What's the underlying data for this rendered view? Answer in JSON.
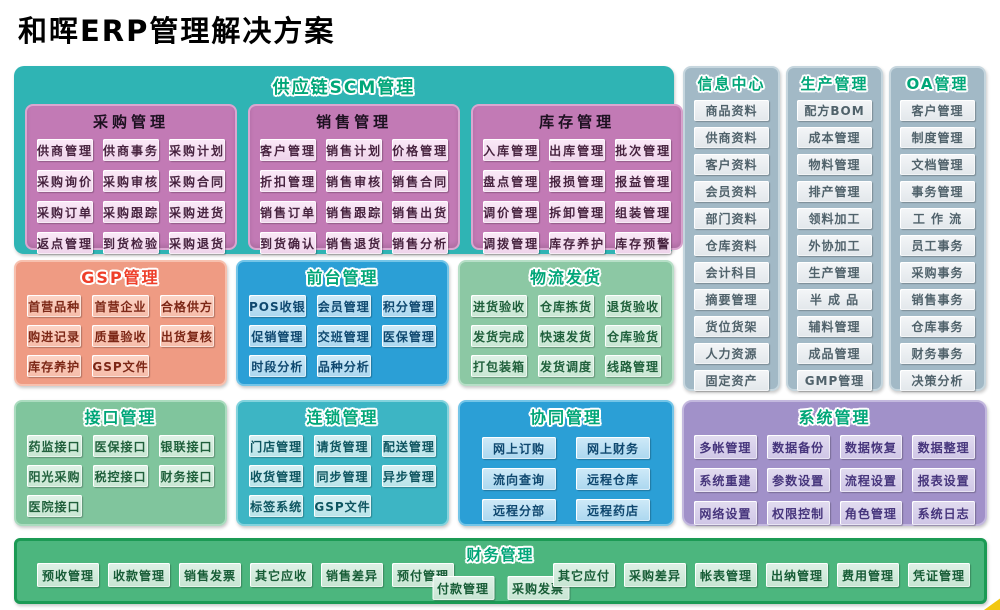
{
  "page_title": "和晖ERP管理解决方案",
  "colors": {
    "scm_bg": "#2fb4b4",
    "subpanel_bg": "#c27ab5",
    "gsp_bg": "#ef9b83",
    "blue_bg": "#2b9fd6",
    "logistics_bg": "#8cc8a4",
    "interface_bg": "#80c59d",
    "chain_bg": "#3db5c4",
    "system_bg": "#a191c9",
    "finance_bg": "#4cb67e",
    "column_bg": "#a2b9c6",
    "title_green": "#00a678",
    "gsp_title_red": "#ee3f2a",
    "corner_yellow": "#f2c711"
  },
  "panels": {
    "scm": {
      "title": "供应链SCM管理",
      "sections": [
        {
          "title": "采购管理",
          "buttons": [
            "供商管理",
            "供商事务",
            "采购计划",
            "采购询价",
            "采购审核",
            "采购合同",
            "采购订单",
            "采购跟踪",
            "采购进货",
            "返点管理",
            "到货检验",
            "采购退货"
          ]
        },
        {
          "title": "销售管理",
          "buttons": [
            "客户管理",
            "销售计划",
            "价格管理",
            "折扣管理",
            "销售审核",
            "销售合同",
            "销售订单",
            "销售跟踪",
            "销售出货",
            "到货确认",
            "销售退货",
            "销售分析"
          ]
        },
        {
          "title": "库存管理",
          "buttons": [
            "入库管理",
            "出库管理",
            "批次管理",
            "盘点管理",
            "报损管理",
            "报益管理",
            "调价管理",
            "拆卸管理",
            "组装管理",
            "调拨管理",
            "库存养护",
            "库存预警"
          ]
        }
      ]
    },
    "info_center": {
      "title": "信息中心",
      "buttons": [
        "商品资料",
        "供商资料",
        "客户资料",
        "会员资料",
        "部门资料",
        "仓库资料",
        "会计科目",
        "摘要管理",
        "货位货架",
        "人力资源",
        "固定资产"
      ]
    },
    "production": {
      "title": "生产管理",
      "buttons": [
        "配方BOM",
        "成本管理",
        "物料管理",
        "排产管理",
        "领料加工",
        "外协加工",
        "生产管理",
        "半 成 品",
        "辅料管理",
        "成品管理",
        "GMP管理"
      ]
    },
    "oa": {
      "title": "OA管理",
      "buttons": [
        "客户管理",
        "制度管理",
        "文档管理",
        "事务管理",
        "工 作 流",
        "员工事务",
        "采购事务",
        "销售事务",
        "仓库事务",
        "财务事务",
        "决策分析"
      ]
    },
    "gsp": {
      "title": "GSP管理",
      "buttons": [
        "首营品种",
        "首营企业",
        "合格供方",
        "购进记录",
        "质量验收",
        "出货复核",
        "库存养护",
        "GSP文件"
      ]
    },
    "front_desk": {
      "title": "前台管理",
      "buttons": [
        "POS收银",
        "会员管理",
        "积分管理",
        "促销管理",
        "交班管理",
        "医保管理",
        "时段分析",
        "品种分析"
      ]
    },
    "logistics": {
      "title": "物流发货",
      "buttons": [
        "进货验收",
        "仓库拣货",
        "退货验收",
        "发货完成",
        "快速发货",
        "仓库验货",
        "打包装箱",
        "发货调度",
        "线路管理"
      ]
    },
    "interface": {
      "title": "接口管理",
      "buttons": [
        "药监接口",
        "医保接口",
        "银联接口",
        "阳光采购",
        "税控接口",
        "财务接口",
        "医院接口"
      ]
    },
    "chain": {
      "title": "连锁管理",
      "buttons": [
        "门店管理",
        "请货管理",
        "配送管理",
        "收货管理",
        "同步管理",
        "异步管理",
        "标签系统",
        "GSP文件"
      ]
    },
    "collaboration": {
      "title": "协同管理",
      "buttons": [
        "网上订购",
        "网上财务",
        "流向查询",
        "远程仓库",
        "远程分部",
        "远程药店"
      ]
    },
    "system": {
      "title": "系统管理",
      "buttons": [
        "多帐管理",
        "数据备份",
        "数据恢复",
        "数据整理",
        "系统重建",
        "参数设置",
        "流程设置",
        "报表设置",
        "网络设置",
        "权限控制",
        "角色管理",
        "系统日志"
      ]
    },
    "finance": {
      "title": "财务管理",
      "left_buttons": [
        "预收管理",
        "收款管理",
        "销售发票",
        "其它应收",
        "销售差异",
        "预付管理"
      ],
      "center_buttons": [
        "付款管理",
        "采购发票"
      ],
      "right_buttons": [
        "其它应付",
        "采购差异",
        "帐表管理",
        "出纳管理",
        "费用管理",
        "凭证管理"
      ]
    }
  }
}
